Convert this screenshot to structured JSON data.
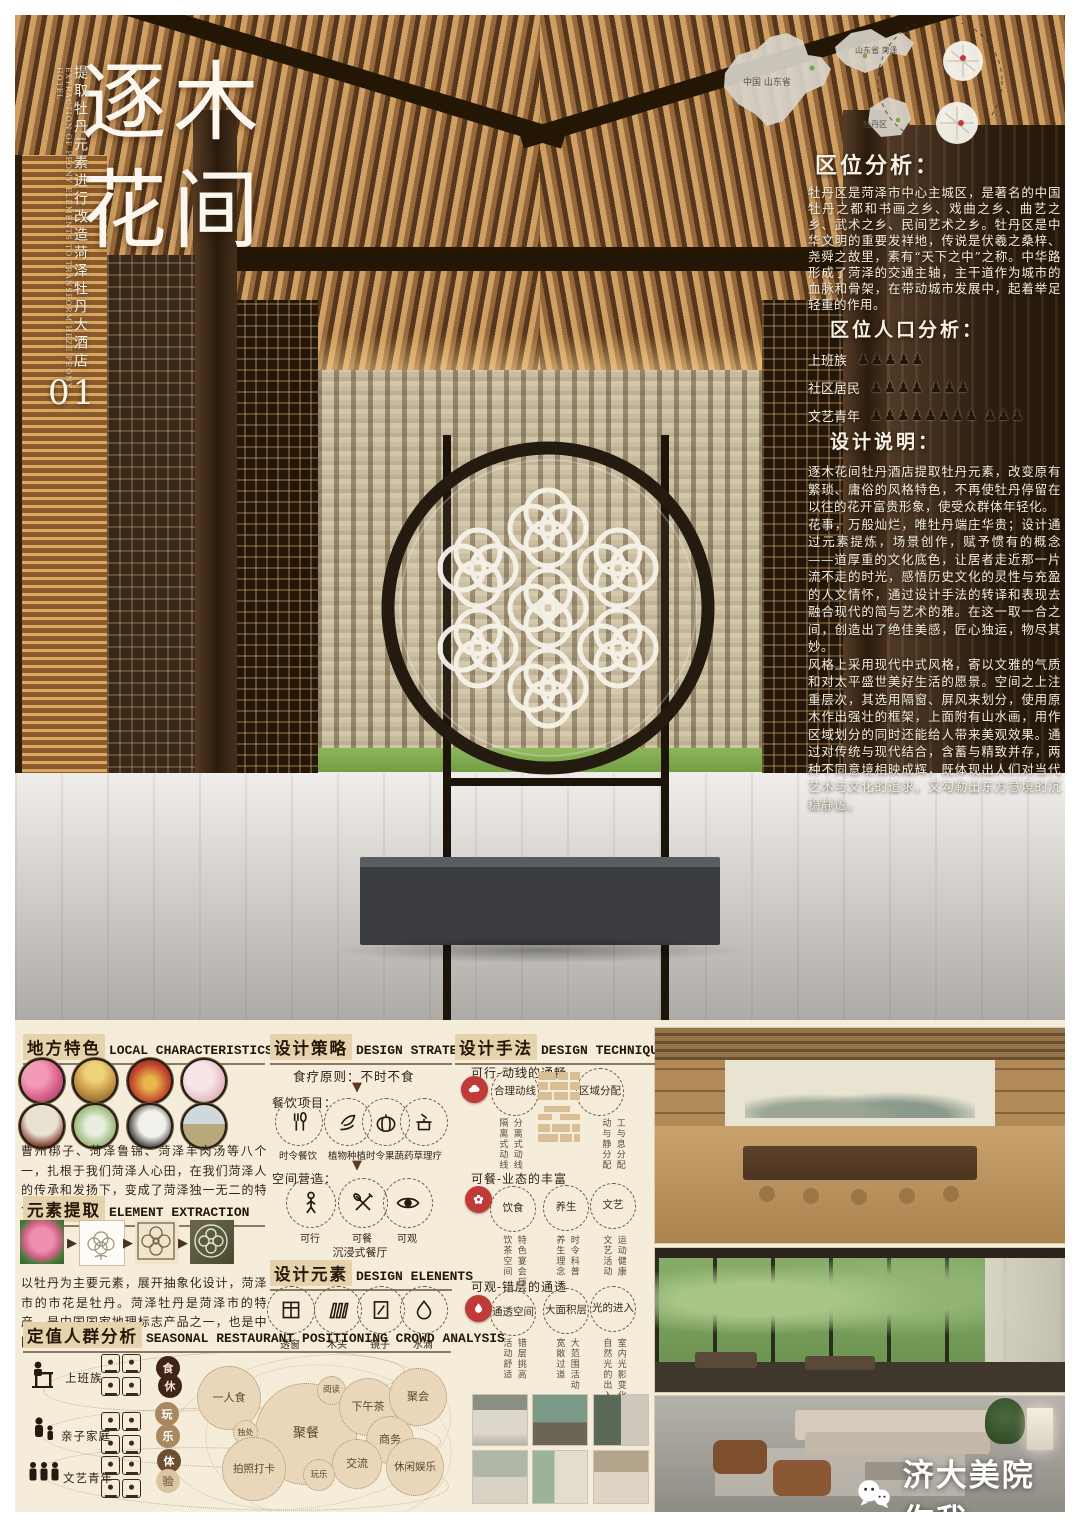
{
  "colors": {
    "accent_red": "#c13a3a",
    "panel_bg": "#f5ecda",
    "header_highlight": "#e7d2ae"
  },
  "poster": {
    "title_chars": [
      "逐",
      "木",
      "花",
      "间"
    ],
    "subtitle_cn": "提取牡丹元素进行改造菏泽牡丹大酒店",
    "subtitle_en": "EXTRACTION OF PEONY ELEMENTS TO TRANSFORM HEZE PEONY HOTEL",
    "index_number": "01"
  },
  "maps": {
    "china_label": "中国 山东省",
    "shandong_label": "山东省 菏泽",
    "district_label": "牡丹区"
  },
  "location": {
    "title": "区位分析：",
    "body": "牡丹区是菏泽市中心主城区，是著名的中国牡丹之都和书画之乡、戏曲之乡、曲艺之乡、武术之乡、民间艺术之乡。牡丹区是中华文明的重要发祥地，传说是伏羲之桑梓、尧舜之故里，素有“天下之中”之称。中华路形成了菏泽的交通主轴，主干道作为城市的血脉和骨架，在带动城市发展中，起着举足轻重的作用。"
  },
  "population": {
    "title": "区位人口分析：",
    "rows": [
      {
        "label": "上班族",
        "icons": "♟♟♟♟♟"
      },
      {
        "label": "社区居民",
        "icons": "♟♟♟♟ ♟♟♟"
      },
      {
        "label": "文艺青年",
        "icons": "♟♟♟♟♟♟♟♟ ♟♟♟"
      }
    ]
  },
  "description": {
    "title": "设计说明：",
    "p1": "逐木花间牡丹酒店提取牡丹元素，改变原有繁琐、庸俗的风格特色，不再使牡丹停留在以往的花开富贵形象，使受众群体年轻化。",
    "p2": "花事，万般灿烂，唯牡丹端庄华贵；设计通过元素提炼，场景创作，赋予惯有的概念——道厚重的文化底色，让居者走近那一片流不走的时光，感悟历史文化的灵性与充盈的人文情怀，通过设计手法的转译和表现去融合现代的简与艺术的雅。在这一取一合之间，创造出了绝佳美感，匠心独运，物尽其妙。",
    "p3": "风格上采用现代中式风格，寄以文雅的气质和对太平盛世美好生活的愿景。空间之上注重层次，其选用隔窗、屏风来划分，使用原木作出强壮的框架，上面附有山水画，用作区域划分的同时还能给人带来美观效果。通过对传统与现代结合，含蓄与精致并存，两种不同意境相映成辉，既体现出人们对当代艺术与文化的追求，又勾勒出东方意境的沉稳静谧。"
  },
  "local": {
    "cn": "地方特色",
    "en": "LOCAL CHARACTERISTICS",
    "photo_names": [
      "peony-photo",
      "opera-figure-photo",
      "festival-food-photo",
      "pale-peony-photo",
      "folk-artist-photo",
      "patterned-plate-photo",
      "black-rooster-photo",
      "scenery-photo"
    ],
    "body": "曹州梆子、菏泽鲁锦、菏泽羊肉汤等八个一，扎根于我们菏泽人心田，在我们菏泽人的传承和发扬下，变成了菏泽独一无二的特色。"
  },
  "extraction": {
    "cn": "元素提取",
    "en": "ELEMENT EXTRACTION",
    "step_names": [
      "peony-photo",
      "line-sketch",
      "abstract-pattern",
      "screen-application"
    ],
    "body": "以牡丹为主要元素，展开抽象化设计，菏泽市的市花是牡丹。菏泽牡丹是菏泽市的特产，是中国国家地理标志产品之一，也是中国的牡丹之都。"
  },
  "crowd": {
    "cn": "定值人群分析",
    "en": "SEASONAL RESTAURANT POSITIONING CROWD ANALYSIS",
    "groups": [
      {
        "label": "上班族"
      },
      {
        "label": "亲子家庭"
      },
      {
        "label": "文艺青年"
      }
    ],
    "keywords": [
      "食",
      "休",
      "玩",
      "乐",
      "体",
      "验"
    ],
    "bubbles": [
      {
        "label": "一人食"
      },
      {
        "label": "聚餐"
      },
      {
        "label": "阅读"
      },
      {
        "label": "下午茶"
      },
      {
        "label": "聚会"
      },
      {
        "label": "独处"
      },
      {
        "label": "商务"
      },
      {
        "label": "交流"
      },
      {
        "label": "拍照打卡"
      },
      {
        "label": "玩乐"
      },
      {
        "label": "休闲娱乐"
      }
    ]
  },
  "strategy": {
    "cn": "设计策略",
    "en": "DESIGN STRATEGY",
    "principle": "食疗原则：不时不食",
    "catering_label": "餐饮项目：",
    "catering": [
      {
        "label": "时令餐饮",
        "icon": "utensils-icon"
      },
      {
        "label": "植物种植",
        "icon": "leaves-icon"
      },
      {
        "label": "时令果蔬",
        "icon": "pumpkin-icon"
      },
      {
        "label": "药草理疗",
        "icon": "herb-pot-icon"
      }
    ],
    "space_label": "空间营造：",
    "space": [
      {
        "label": "可行",
        "icon": "person-icon"
      },
      {
        "label": "可餐",
        "icon": "cutlery-icon"
      },
      {
        "label": "可观",
        "icon": "eye-icon"
      }
    ],
    "footer": "沉浸式餐厅"
  },
  "elements": {
    "cn": "设计元素",
    "en": "DESIGN ELENENTS",
    "items": [
      {
        "label": "透窗",
        "icon": "window-icon"
      },
      {
        "label": "木头",
        "icon": "wood-icon"
      },
      {
        "label": "镜子",
        "icon": "mirror-icon"
      },
      {
        "label": "水滴",
        "icon": "waterdrop-icon"
      }
    ]
  },
  "technique": {
    "cn": "设计手法",
    "en": "DESIGN TECHNIQUE",
    "sections": [
      {
        "title": "可行-动线的通畅",
        "circles": [
          "合理动线",
          "区域分配"
        ],
        "notes_left": [
          "隔离式动线",
          "分离式动线"
        ],
        "notes_right": [
          "动与静分配",
          "工与息分配"
        ]
      },
      {
        "title": "可餐-业态的丰富",
        "circles": [
          "饮食",
          "养生",
          "文艺"
        ],
        "notes": [
          [
            "饮茶空间",
            "特色宴会厅"
          ],
          [
            "养生理念",
            "时令科普"
          ],
          [
            "文艺活动",
            "运动健康"
          ]
        ]
      },
      {
        "title": "可观-错层的通透",
        "circles": [
          "通透空间",
          "大面积层",
          "光的进入"
        ],
        "notes": [
          [
            "活动舒适",
            "错层挑高"
          ],
          [
            "宽敞过道",
            "大范围活动"
          ],
          [
            "自然光的出入",
            "室内光影变化"
          ]
        ]
      }
    ]
  },
  "branding": {
    "logo_text": "济大美院你我",
    "icon": "wechat-icon"
  }
}
